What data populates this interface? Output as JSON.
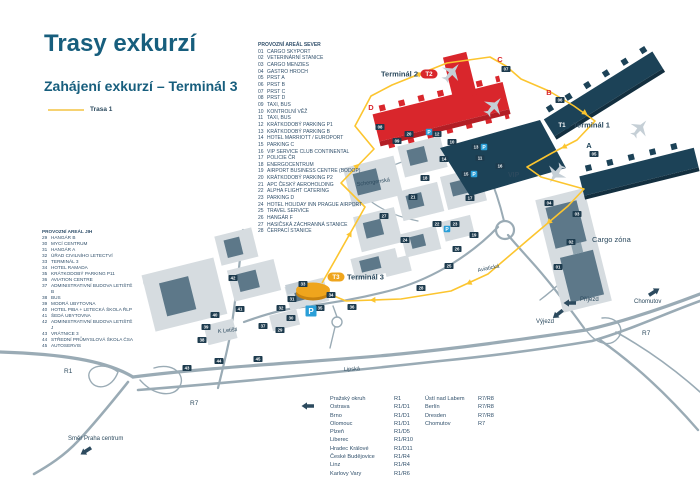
{
  "title": "Trasy exkurzí",
  "subtitle": "Zahájení exkurzí – Terminál 3",
  "legend": {
    "route_label": "Trasa 1"
  },
  "colors": {
    "heading": "#175e7d",
    "text_navy": "#31506b",
    "route_yellow": "#fcc52f",
    "terminal2_red": "#d9262c",
    "terminal1_navy": "#1c4257",
    "terminal3_yellow": "#efa51d",
    "badge_navy": "#1d3b4e",
    "parking_blue": "#2a9fd8",
    "road_gray": "#9aabb5"
  },
  "icons": {
    "table_arrow": "arrow-left",
    "praha_arrow": "arrow-southwest",
    "chomutov_arrow": "arrow-northeast",
    "prijezd_arrow": "arrow-left",
    "vyjezd_arrow": "arrow-southeast",
    "planes": "airplane"
  },
  "area_north": {
    "header": "PROVOZNÍ AREÁL SEVER",
    "items": [
      {
        "num": "01",
        "label": "CARGO SKYPORT"
      },
      {
        "num": "02",
        "label": "VETERINÁRNÍ STANICE"
      },
      {
        "num": "03",
        "label": "CARGO MENZIES"
      },
      {
        "num": "04",
        "label": "GASTRO HROCH"
      },
      {
        "num": "05",
        "label": "PRST A"
      },
      {
        "num": "06",
        "label": "PRST B"
      },
      {
        "num": "07",
        "label": "PRST C"
      },
      {
        "num": "08",
        "label": "PRST D"
      },
      {
        "num": "09",
        "label": "TAXI, BUS"
      },
      {
        "num": "10",
        "label": "KONTROLNÍ VĚŽ"
      },
      {
        "num": "11",
        "label": "TAXI, BUS"
      },
      {
        "num": "12",
        "label": "KRÁTKODOBÝ PARKING P1"
      },
      {
        "num": "13",
        "label": "KRÁTKODOBÝ PARKING B"
      },
      {
        "num": "14",
        "label": "HOTEL MARRIOTT / EUROPORT"
      },
      {
        "num": "15",
        "label": "PARKING C"
      },
      {
        "num": "16",
        "label": "VIP SERVICE CLUB CONTINENTAL"
      },
      {
        "num": "17",
        "label": "POLICIE ČR"
      },
      {
        "num": "18",
        "label": "ENERGOCENTRUM"
      },
      {
        "num": "19",
        "label": "AIRPORT BUSINESS CENTRE (BODOP)"
      },
      {
        "num": "20",
        "label": "KRÁTKODOBÝ PARKING P2"
      },
      {
        "num": "21",
        "label": "APC ČESKÝ AEROHOLDING"
      },
      {
        "num": "22",
        "label": "ALPHA FLIGHT CATERING"
      },
      {
        "num": "23",
        "label": "PARKING D"
      },
      {
        "num": "24",
        "label": "HOTEL HOLIDAY INN PRAGUE AIRPORT"
      },
      {
        "num": "25",
        "label": "TRAVEL SERVICE"
      },
      {
        "num": "26",
        "label": "HANGÁR F"
      },
      {
        "num": "27",
        "label": "HASIČSKÁ ZÁCHRANNÁ STANICE"
      },
      {
        "num": "28",
        "label": "ČERPACÍ STANICE"
      }
    ]
  },
  "area_south": {
    "header": "PROVOZNÍ AREÁL JIH",
    "items": [
      {
        "num": "29",
        "label": "HANGÁR B"
      },
      {
        "num": "30",
        "label": "MYCÍ CENTRUM"
      },
      {
        "num": "31",
        "label": "HANGÁR A"
      },
      {
        "num": "32",
        "label": "ÚŘAD CIVILNÍHO LETECTVÍ"
      },
      {
        "num": "33",
        "label": "TERMINÁL 3"
      },
      {
        "num": "34",
        "label": "HOTEL RAMADA"
      },
      {
        "num": "35",
        "label": "KRÁTKODOBÝ PARKING P11"
      },
      {
        "num": "36",
        "label": "AVIATION CENTRE"
      },
      {
        "num": "37",
        "label": "ADMINISTRATIVNÍ BUDOVA LETIŠTĚ B"
      },
      {
        "num": "38",
        "label": "BUS"
      },
      {
        "num": "39",
        "label": "MODRÁ UBYTOVNA"
      },
      {
        "num": "40",
        "label": "HOTEL PIBA + LETECKÁ ŠKOLA ŘLP"
      },
      {
        "num": "41",
        "label": "ŠEDÁ UBYTOVNA"
      },
      {
        "num": "42",
        "label": "ADMINISTRATIVNÍ BUDOVA LETIŠTĚ J"
      },
      {
        "num": "43",
        "label": "VRÁTNICE 3"
      },
      {
        "num": "44",
        "label": "STŘEDNÍ PRŮMYSLOVÁ ŠKOLA ČSA"
      },
      {
        "num": "45",
        "label": "AUTOSERVIS"
      }
    ]
  },
  "map": {
    "terminals": [
      {
        "id": "T2",
        "label": "Terminál 2",
        "px": 429,
        "py": 74,
        "color": "#d9262c",
        "side": "left"
      },
      {
        "id": "T1",
        "label": "Terminál 1",
        "px": 562,
        "py": 125,
        "color": "#1c4257",
        "side": "right"
      },
      {
        "id": "T3",
        "label": "Terminál 3",
        "px": 336,
        "py": 277,
        "color": "#efa51d",
        "side": "right"
      }
    ],
    "piers": [
      {
        "t": "C",
        "x": 500,
        "y": 62,
        "c": "#d9262c"
      },
      {
        "t": "B",
        "x": 549,
        "y": 95,
        "c": "#d9262c"
      },
      {
        "t": "D",
        "x": 371,
        "y": 110,
        "c": "#d9262c"
      },
      {
        "t": "A",
        "x": 589,
        "y": 148,
        "c": "#1c4257"
      }
    ],
    "labels": [
      {
        "t": "VIP",
        "x": 508,
        "y": 177,
        "s": 7,
        "c": "#2c4a5e",
        "w": "bold"
      },
      {
        "t": "Cargo zóna",
        "x": 592,
        "y": 242,
        "s": 7.5,
        "c": "#2c4a5e"
      },
      {
        "t": "Schengenská",
        "x": 357,
        "y": 186,
        "s": 5.5,
        "c": "#2c4a5e",
        "r": -8
      },
      {
        "t": "Aviatická",
        "x": 478,
        "y": 272,
        "s": 5.5,
        "c": "#2c4a5e",
        "r": -12
      },
      {
        "t": "Lipská",
        "x": 344,
        "y": 371,
        "s": 5.5,
        "c": "#2c4a5e",
        "r": -3
      },
      {
        "t": "K Letišti",
        "x": 218,
        "y": 333,
        "s": 5.5,
        "c": "#2c4a5e",
        "r": -6
      },
      {
        "t": "R1",
        "x": 64,
        "y": 373,
        "s": 6.5,
        "c": "#2c4a5e"
      },
      {
        "t": "R7",
        "x": 190,
        "y": 405,
        "s": 6.5,
        "c": "#2c4a5e"
      },
      {
        "t": "R7",
        "x": 642,
        "y": 335,
        "s": 6.5,
        "c": "#2c4a5e"
      },
      {
        "t": "Chomutov",
        "x": 634,
        "y": 303,
        "s": 6,
        "c": "#2c4a5e"
      },
      {
        "t": "Příjezd",
        "x": 580,
        "y": 301,
        "s": 6,
        "c": "#2c4a5e"
      },
      {
        "t": "Výjezd",
        "x": 536,
        "y": 323,
        "s": 6,
        "c": "#2c4a5e"
      },
      {
        "t": "Směr Praha centrum",
        "x": 68,
        "y": 440,
        "s": 6,
        "c": "#2c4a5e"
      }
    ],
    "badges": [
      {
        "n": "01",
        "x": 558,
        "y": 267
      },
      {
        "n": "02",
        "x": 571,
        "y": 242
      },
      {
        "n": "03",
        "x": 577,
        "y": 214
      },
      {
        "n": "04",
        "x": 549,
        "y": 203
      },
      {
        "n": "05",
        "x": 594,
        "y": 154
      },
      {
        "n": "06",
        "x": 560,
        "y": 100
      },
      {
        "n": "07",
        "x": 506,
        "y": 69
      },
      {
        "n": "08",
        "x": 380,
        "y": 127
      },
      {
        "n": "09",
        "x": 397,
        "y": 141
      },
      {
        "n": "10",
        "x": 452,
        "y": 142
      },
      {
        "n": "11",
        "x": 480,
        "y": 158
      },
      {
        "n": "12",
        "x": 437,
        "y": 134
      },
      {
        "n": "13",
        "x": 476,
        "y": 147
      },
      {
        "n": "14",
        "x": 444,
        "y": 159
      },
      {
        "n": "15",
        "x": 466,
        "y": 174
      },
      {
        "n": "16",
        "x": 500,
        "y": 166
      },
      {
        "n": "17",
        "x": 470,
        "y": 198
      },
      {
        "n": "18",
        "x": 425,
        "y": 178
      },
      {
        "n": "19",
        "x": 474,
        "y": 235
      },
      {
        "n": "20",
        "x": 409,
        "y": 134
      },
      {
        "n": "21",
        "x": 413,
        "y": 197
      },
      {
        "n": "22",
        "x": 437,
        "y": 224
      },
      {
        "n": "23",
        "x": 455,
        "y": 224
      },
      {
        "n": "24",
        "x": 405,
        "y": 240
      },
      {
        "n": "25",
        "x": 449,
        "y": 266
      },
      {
        "n": "26",
        "x": 457,
        "y": 249
      },
      {
        "n": "27",
        "x": 384,
        "y": 216
      },
      {
        "n": "28",
        "x": 421,
        "y": 288
      },
      {
        "n": "29",
        "x": 280,
        "y": 330
      },
      {
        "n": "30",
        "x": 291,
        "y": 318
      },
      {
        "n": "31",
        "x": 292,
        "y": 299
      },
      {
        "n": "32",
        "x": 281,
        "y": 308
      },
      {
        "n": "33",
        "x": 303,
        "y": 284
      },
      {
        "n": "34",
        "x": 331,
        "y": 295
      },
      {
        "n": "35",
        "x": 320,
        "y": 308
      },
      {
        "n": "36",
        "x": 352,
        "y": 307
      },
      {
        "n": "37",
        "x": 263,
        "y": 326
      },
      {
        "n": "38",
        "x": 202,
        "y": 340
      },
      {
        "n": "39",
        "x": 206,
        "y": 327
      },
      {
        "n": "40",
        "x": 215,
        "y": 315
      },
      {
        "n": "41",
        "x": 240,
        "y": 309
      },
      {
        "n": "42",
        "x": 233,
        "y": 278
      },
      {
        "n": "43",
        "x": 187,
        "y": 368
      },
      {
        "n": "44",
        "x": 219,
        "y": 361
      },
      {
        "n": "45",
        "x": 258,
        "y": 359
      }
    ],
    "p_badges": [
      {
        "x": 429,
        "y": 132
      },
      {
        "x": 484,
        "y": 147
      },
      {
        "x": 474,
        "y": 174
      },
      {
        "x": 447,
        "y": 229
      },
      {
        "x": 311,
        "y": 311,
        "big": true
      }
    ],
    "parking_letter": "P"
  },
  "routes_table": {
    "left": [
      {
        "dest": "Pražský okruh",
        "route": "R1"
      },
      {
        "dest": "Ostrava",
        "route": "R1/D1"
      },
      {
        "dest": "Brno",
        "route": "R1/D1"
      },
      {
        "dest": "Olomouc",
        "route": "R1/D1"
      },
      {
        "dest": "Plzeň",
        "route": "R1/D5"
      },
      {
        "dest": "Liberec",
        "route": "R1/R10"
      },
      {
        "dest": "Hradec Králové",
        "route": "R1/D11"
      },
      {
        "dest": "České Budějovice",
        "route": "R1/R4"
      },
      {
        "dest": "Linz",
        "route": "R1/R4"
      },
      {
        "dest": "Karlovy Vary",
        "route": "R1/R6"
      }
    ],
    "right": [
      {
        "dest": "Ústí nad Labem",
        "route": "R7/R8"
      },
      {
        "dest": "Berlín",
        "route": "R7/R8"
      },
      {
        "dest": "Dresden",
        "route": "R7/R8"
      },
      {
        "dest": "Chomutov",
        "route": "R7"
      }
    ]
  }
}
